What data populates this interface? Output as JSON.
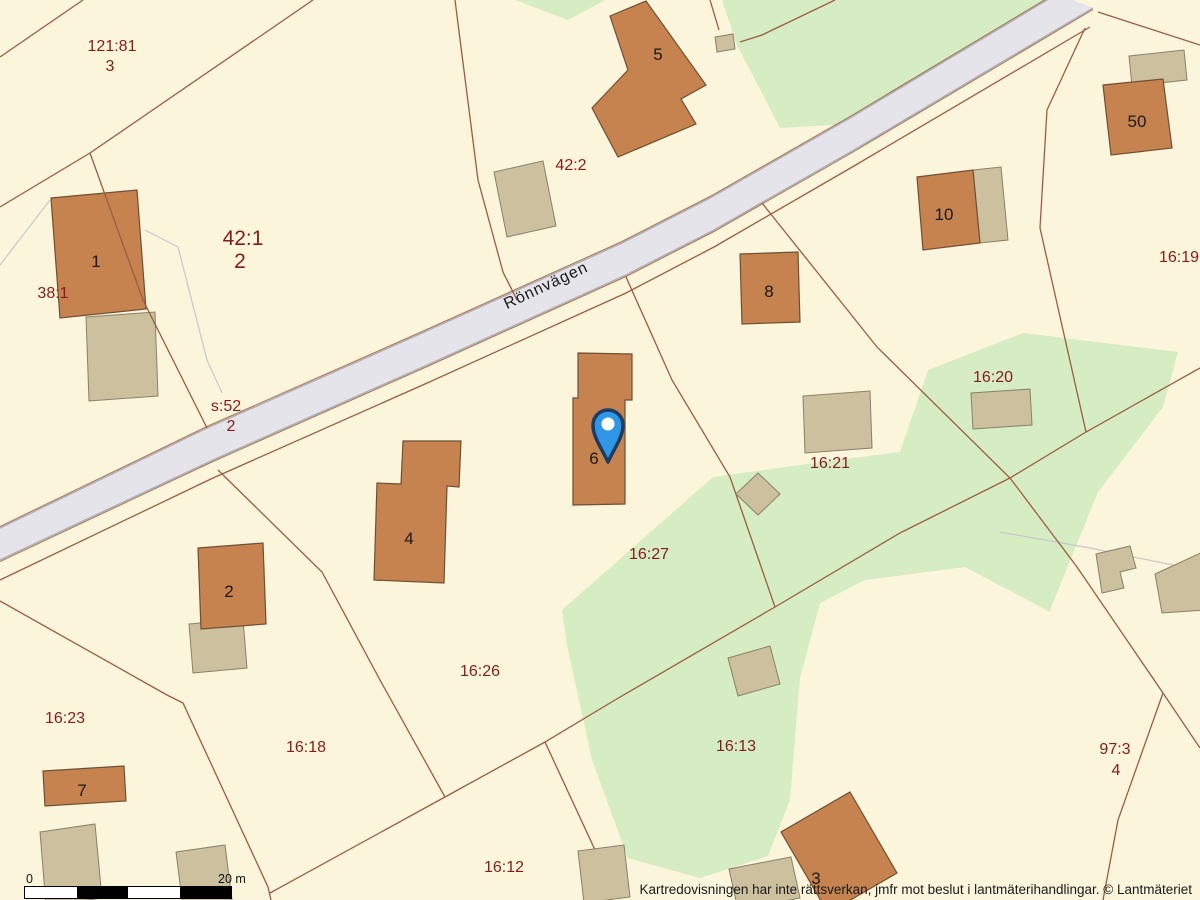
{
  "map": {
    "background_color": "#FAF5DB",
    "colors": {
      "green": "#D6ECC3",
      "road_fill": "#E4E4EA",
      "road_edge": "#AEAEB6",
      "parcel_line": "#9C5C42",
      "gray_line": "#C9C9C9",
      "building_fill": "#C6834F",
      "building_stroke": "#6E4F33",
      "outbuilding_fill": "#CCC09E",
      "outbuilding_stroke": "#8A8166",
      "label_red": "#871B1B",
      "label_black": "#1A1A1A",
      "pin_fill": "#2F97E6",
      "pin_stroke": "#1D3C63"
    },
    "road": {
      "name": "Rönnvägen",
      "label_x": 548,
      "label_y": 290,
      "label_rotation": -25,
      "upper_edge": "0,528 207,428 420,334 622,243 710,198 850,118 1057,-6",
      "lower_edge": "0,560 213,460 425,366 626,275 714,230 854,150 1093,8"
    },
    "green_areas": [
      {
        "name": "green-top-right",
        "points": "722,0 737,45 780,128 848,124 1056,0"
      },
      {
        "name": "green-top-small",
        "points": "515,0 605,0 568,20"
      },
      {
        "name": "green-middle",
        "points": "928,370 1023,333 1178,352 1163,407 1098,492 1052,605 1050,612 965,567 865,580 820,603 800,678 790,800 768,856 700,878 628,858 592,760 567,645 562,610 713,477 800,465 900,452"
      }
    ],
    "gray_lines": [
      "0,265 50,200",
      "145,230 178,247 207,360 222,393",
      "1000,532 1090,548 1163,563 1200,570"
    ],
    "parcel_lines": [
      "0,57 83,0",
      "313,0 90,153 0,207",
      "455,0 478,180 503,272 517,300",
      "710,0 719,30",
      "835,0 762,35 740,42",
      "0,580 213,478 425,384 626,293 714,247 854,166 1090,27",
      "1085,28 1047,110 1040,228 1086,432",
      "1098,12 1200,45",
      "762,203 877,347 1010,478 1077,567 1163,693 1200,748",
      "1163,693 1118,820 1103,900",
      "1200,368 1086,432 1010,478 900,533 775,607",
      "626,277 672,380 730,477 775,607",
      "775,607 615,700 545,742 445,797 270,893",
      "545,742 602,865 612,900",
      "218,470 322,572 380,680 445,797",
      "0,601 167,695 183,703 268,887 271,900"
    ],
    "parcel_line_over_buildings": "90,153 143,300 207,428",
    "buildings": [
      {
        "label": "1",
        "points": "51,198 137,190 146,309 60,318",
        "label_x": 96,
        "label_y": 267
      },
      {
        "label": "5",
        "points": "610,16 646,1 706,85 681,99 696,124 618,157 592,108 628,70",
        "label_x": 658,
        "label_y": 60
      },
      {
        "label": "8",
        "points": "740,254 798,252 800,322 742,324",
        "label_x": 769,
        "label_y": 297
      },
      {
        "label": "10",
        "points": "917,177 973,170 980,243 923,250",
        "label_x": 944,
        "label_y": 220
      },
      {
        "label": "50",
        "points": "1103,85 1163,79 1172,148 1111,155",
        "label_x": 1137,
        "label_y": 127
      },
      {
        "label": "6",
        "points": "578,353 632,354 632,400 625,400 625,504 573,505 573,398 578,398",
        "label_x": 594,
        "label_y": 464
      },
      {
        "label": "4",
        "points": "403,441 461,441 459,487 447,486 444,583 374,580 377,483 401,484",
        "label_x": 409,
        "label_y": 544
      },
      {
        "label": "2",
        "points": "198,548 263,543 266,624 201,629",
        "label_x": 229,
        "label_y": 597
      },
      {
        "label": "7",
        "points": "43,771 124,766 126,801 45,806",
        "label_x": 82,
        "label_y": 796
      },
      {
        "label": "3",
        "points": "850,792 897,873 828,913 781,832",
        "label_x": 816,
        "label_y": 884
      }
    ],
    "outbuildings": [
      {
        "points": "86,317 155,312 158,396 89,401"
      },
      {
        "points": "494,172 543,161 556,226 507,237"
      },
      {
        "points": "715,37 733,34 735,49 717,52"
      },
      {
        "points": "1129,56 1184,50 1187,80 1132,86"
      },
      {
        "points": "973,170 1001,167 1008,240 980,243"
      },
      {
        "points": "971,393 1030,389 1032,425 973,429"
      },
      {
        "points": "803,396 870,391 872,448 805,453"
      },
      {
        "points": "758,473 780,494 758,515 736,494"
      },
      {
        "points": "728,658 770,646 780,684 738,696"
      },
      {
        "points": "189,624 243,619 247,668 193,673"
      },
      {
        "points": "40,832 95,824 102,898 46,906"
      },
      {
        "points": "176,852 225,845 232,900 183,907"
      },
      {
        "points": "578,851 624,845 630,897 584,903"
      },
      {
        "points": "729,869 791,857 800,898 738,910"
      },
      {
        "points": "1155,574 1205,551 1205,610 1162,613"
      },
      {
        "points": "1096,554 1130,546 1136,568 1120,572 1124,588 1102,593"
      }
    ],
    "parcel_labels": [
      {
        "text": "121:81",
        "x": 112,
        "y": 51,
        "size": 16
      },
      {
        "text": "3",
        "x": 110,
        "y": 71,
        "size": 16
      },
      {
        "text": "42:1",
        "x": 243,
        "y": 245,
        "size": 21
      },
      {
        "text": "2",
        "x": 240,
        "y": 268,
        "size": 21
      },
      {
        "text": "38:1",
        "x": 53,
        "y": 298,
        "size": 16
      },
      {
        "text": "s:52",
        "x": 226,
        "y": 411,
        "size": 16
      },
      {
        "text": "2",
        "x": 231,
        "y": 431,
        "size": 16
      },
      {
        "text": "42:2",
        "x": 571,
        "y": 170,
        "size": 16
      },
      {
        "text": "16:19",
        "x": 1179,
        "y": 262,
        "size": 16
      },
      {
        "text": "16:20",
        "x": 993,
        "y": 382,
        "size": 16
      },
      {
        "text": "16:21",
        "x": 830,
        "y": 468,
        "size": 16
      },
      {
        "text": "16:27",
        "x": 649,
        "y": 559,
        "size": 16
      },
      {
        "text": "16:26",
        "x": 480,
        "y": 676,
        "size": 16
      },
      {
        "text": "16:23",
        "x": 65,
        "y": 723,
        "size": 16
      },
      {
        "text": "16:18",
        "x": 306,
        "y": 752,
        "size": 16
      },
      {
        "text": "16:13",
        "x": 736,
        "y": 751,
        "size": 16
      },
      {
        "text": "16:12",
        "x": 504,
        "y": 872,
        "size": 16
      },
      {
        "text": "97:3",
        "x": 1115,
        "y": 754,
        "size": 16
      },
      {
        "text": "4",
        "x": 1116,
        "y": 775,
        "size": 16
      }
    ],
    "pin": {
      "x": 608,
      "y": 425,
      "tip_y": 462
    },
    "scale_bar": {
      "zero_label": "0",
      "distance_label": "20 m",
      "segment_colors": [
        "#ffffff",
        "#000000",
        "#ffffff",
        "#000000"
      ]
    },
    "attribution": "Kartredovisningen har inte rättsverkan, jmfr mot beslut i lantmäterihandlingar. © Lantmäteriet"
  }
}
